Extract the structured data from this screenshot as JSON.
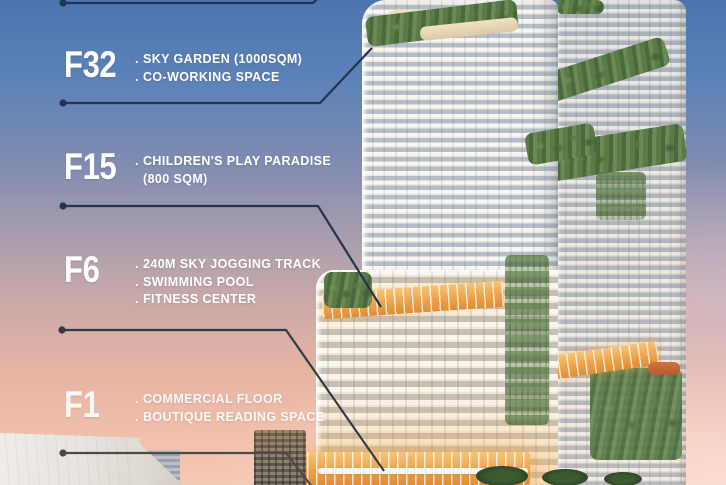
{
  "palette": {
    "sky_top": "#4d74ad",
    "sky_mid": "#ab9fae",
    "sky_bottom": "#f4c9b4",
    "label_text": "#ffffff",
    "connector_blue": "#24344e",
    "connector_dark": "#343a45",
    "connector_warm": "#4f4944",
    "amber": "#eda24a",
    "greenery": "#5a7a46",
    "facade_white": "#f9f7f3",
    "facade_shadow": "#b6bdc6"
  },
  "annotations": {
    "floors": [
      {
        "label": "F32",
        "lines": [
          {
            "bullet": ".",
            "text": "SKY GARDEN (1000SQM)"
          },
          {
            "bullet": ".",
            "text": "CO-WORKING SPACE"
          }
        ]
      },
      {
        "label": "F15",
        "lines": [
          {
            "bullet": ".",
            "text": "CHILDREN'S PLAY PARADISE"
          },
          {
            "bullet": "",
            "text": "(800 SQM)"
          }
        ]
      },
      {
        "label": "F6",
        "lines": [
          {
            "bullet": ".",
            "text": "240M SKY JOGGING TRACK"
          },
          {
            "bullet": ".",
            "text": "SWIMMING POOL"
          },
          {
            "bullet": ".",
            "text": "FITNESS CENTER"
          }
        ]
      },
      {
        "label": "F1",
        "lines": [
          {
            "bullet": ".",
            "text": "COMMERCIAL FLOOR"
          },
          {
            "bullet": ".",
            "text": "BOUTIQUE READING SPACE"
          }
        ]
      }
    ]
  }
}
